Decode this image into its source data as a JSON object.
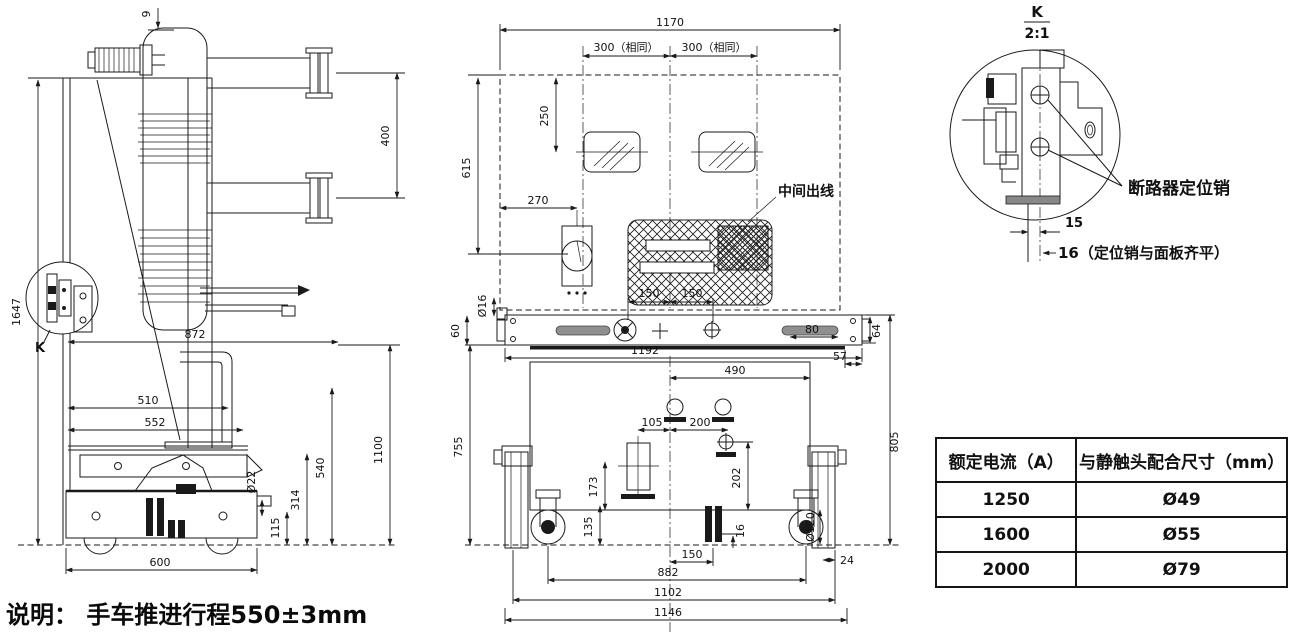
{
  "note": "说明： 手车推进行程550±3mm",
  "side_view": {
    "dims": {
      "d9": "9",
      "d1647": "1647",
      "d400": "400",
      "d872": "872",
      "d1100": "1100",
      "d510": "510",
      "d552": "552",
      "d540": "540",
      "d314": "314",
      "d115": "115",
      "d22": "Ø22",
      "d600": "600"
    },
    "detail_ref": "K"
  },
  "front_view": {
    "outlet_label": "中间出线",
    "dims": {
      "d1170": "1170",
      "d300a": "300（相同）",
      "d300b": "300（相同）",
      "d250": "250",
      "d615": "615",
      "d270": "270",
      "d150a": "150",
      "d150b": "150",
      "d16hole": "Ø16",
      "d60": "60",
      "d1192": "1192",
      "d80": "80",
      "d64": "64",
      "d57": "57",
      "d490": "490",
      "d105": "105",
      "d200": "200",
      "d202": "202",
      "d173": "173",
      "d805": "805",
      "d755": "755",
      "d135": "135",
      "d150c": "150",
      "d16": "16",
      "d120": "Ø120",
      "d24": "24",
      "d882": "882",
      "d1102": "1102",
      "d1146": "1146"
    }
  },
  "detail_k": {
    "ref": "K",
    "scale": "2:1",
    "pin_label": "断路器定位销",
    "d15": "15",
    "d16note": "16（定位销与面板齐平）"
  },
  "table": {
    "headers": [
      "额定电流（A）",
      "与静触头配合尺寸（mm）"
    ],
    "rows": [
      [
        "1250",
        "Ø49"
      ],
      [
        "1600",
        "Ø55"
      ],
      [
        "2000",
        "Ø79"
      ]
    ]
  },
  "colors": {
    "line": "#1a1a1a",
    "background": "#ffffff"
  }
}
